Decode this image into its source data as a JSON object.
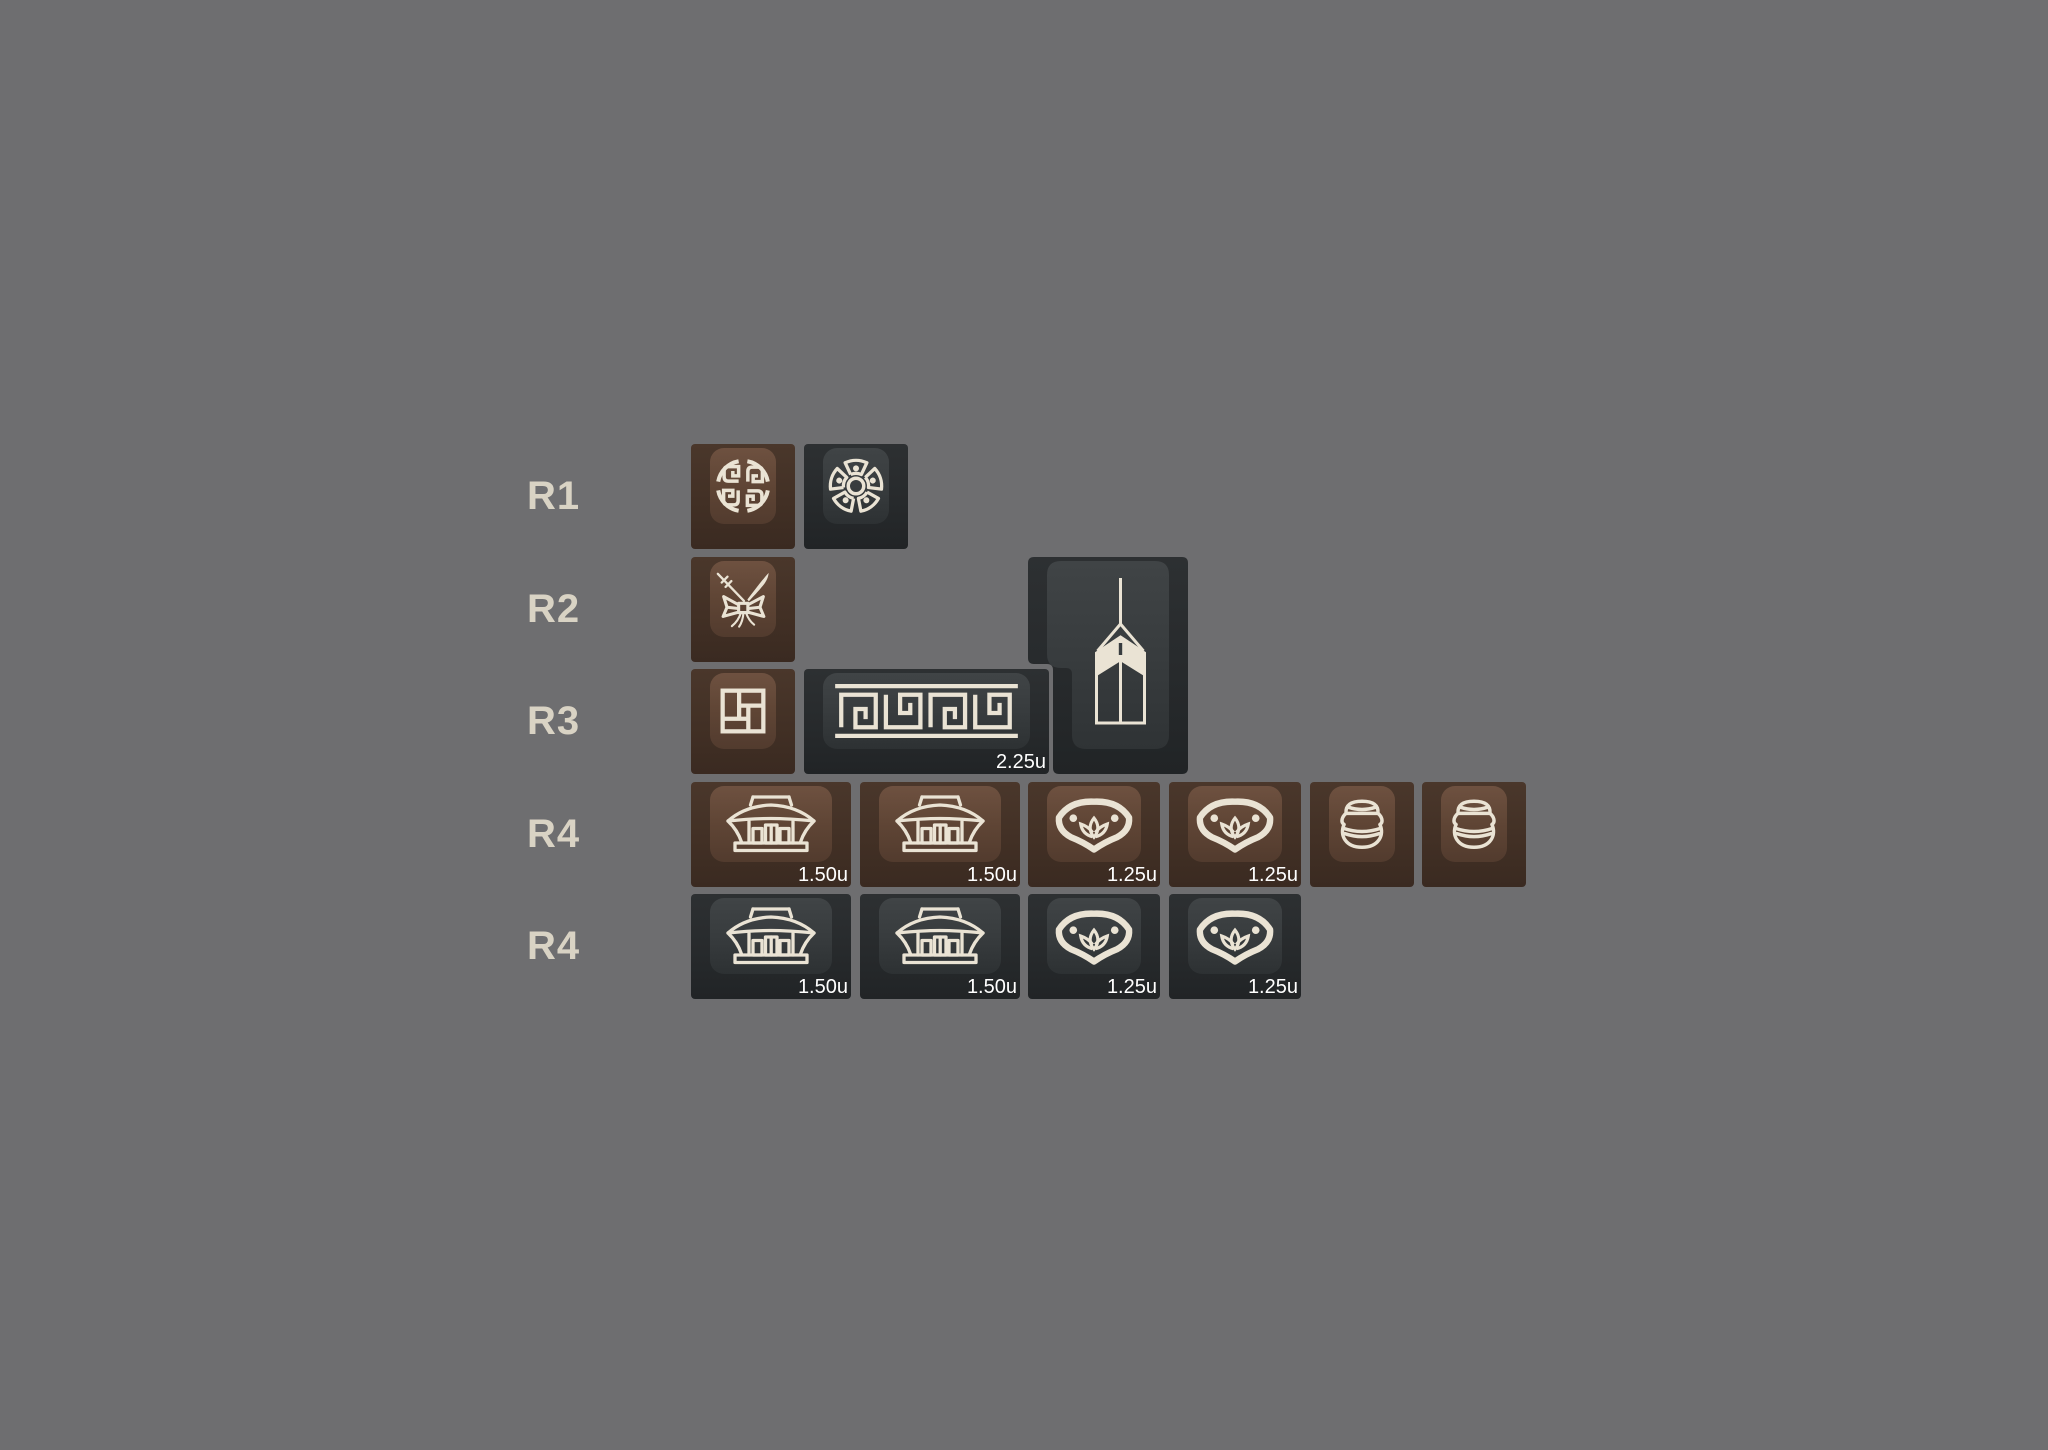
{
  "canvas": {
    "width": 2048,
    "height": 1450,
    "background": "#6e6e70"
  },
  "colors": {
    "background": "#6e6e70",
    "row_label_text": "#d9d3c4",
    "legend_cream": "#eae3d4",
    "size_label_text": "#ffffff",
    "brown_key_base": "#423025",
    "brown_key_face": "#5f4535",
    "dark_key_base": "#272a2c",
    "dark_key_face": "#383c3e"
  },
  "rows": [
    {
      "label": "R1",
      "keys": [
        {
          "icon": "longevity-medallion",
          "color": "brown",
          "width": "1u"
        },
        {
          "icon": "coin-wheel",
          "color": "dark",
          "width": "1u"
        }
      ]
    },
    {
      "label": "R2",
      "keys": [
        {
          "icon": "ribbon-bow",
          "color": "brown",
          "width": "1u"
        },
        {
          "icon": "norigae-pendant",
          "color": "dark",
          "width": "iso-enter"
        }
      ]
    },
    {
      "label": "R3",
      "keys": [
        {
          "icon": "brick-pinwheel",
          "color": "brown",
          "width": "1u"
        },
        {
          "icon": "meander-border",
          "color": "dark",
          "width": "2.25u",
          "size_label": "2.25u"
        }
      ]
    },
    {
      "label": "R4",
      "keys": [
        {
          "icon": "temple",
          "color": "brown",
          "width": "1.5u",
          "size_label": "1.50u"
        },
        {
          "icon": "temple",
          "color": "brown",
          "width": "1.5u",
          "size_label": "1.50u"
        },
        {
          "icon": "lotus-collar",
          "color": "brown",
          "width": "1.25u",
          "size_label": "1.25u"
        },
        {
          "icon": "lotus-collar",
          "color": "brown",
          "width": "1.25u",
          "size_label": "1.25u"
        },
        {
          "icon": "onggi-jar",
          "color": "brown",
          "width": "1u"
        },
        {
          "icon": "onggi-jar",
          "color": "brown",
          "width": "1u"
        }
      ]
    },
    {
      "label": "R4",
      "keys": [
        {
          "icon": "temple",
          "color": "dark",
          "width": "1.5u",
          "size_label": "1.50u"
        },
        {
          "icon": "temple",
          "color": "dark",
          "width": "1.5u",
          "size_label": "1.50u"
        },
        {
          "icon": "lotus-collar",
          "color": "dark",
          "width": "1.25u",
          "size_label": "1.25u"
        },
        {
          "icon": "lotus-collar",
          "color": "dark",
          "width": "1.25u",
          "size_label": "1.25u"
        }
      ]
    }
  ]
}
